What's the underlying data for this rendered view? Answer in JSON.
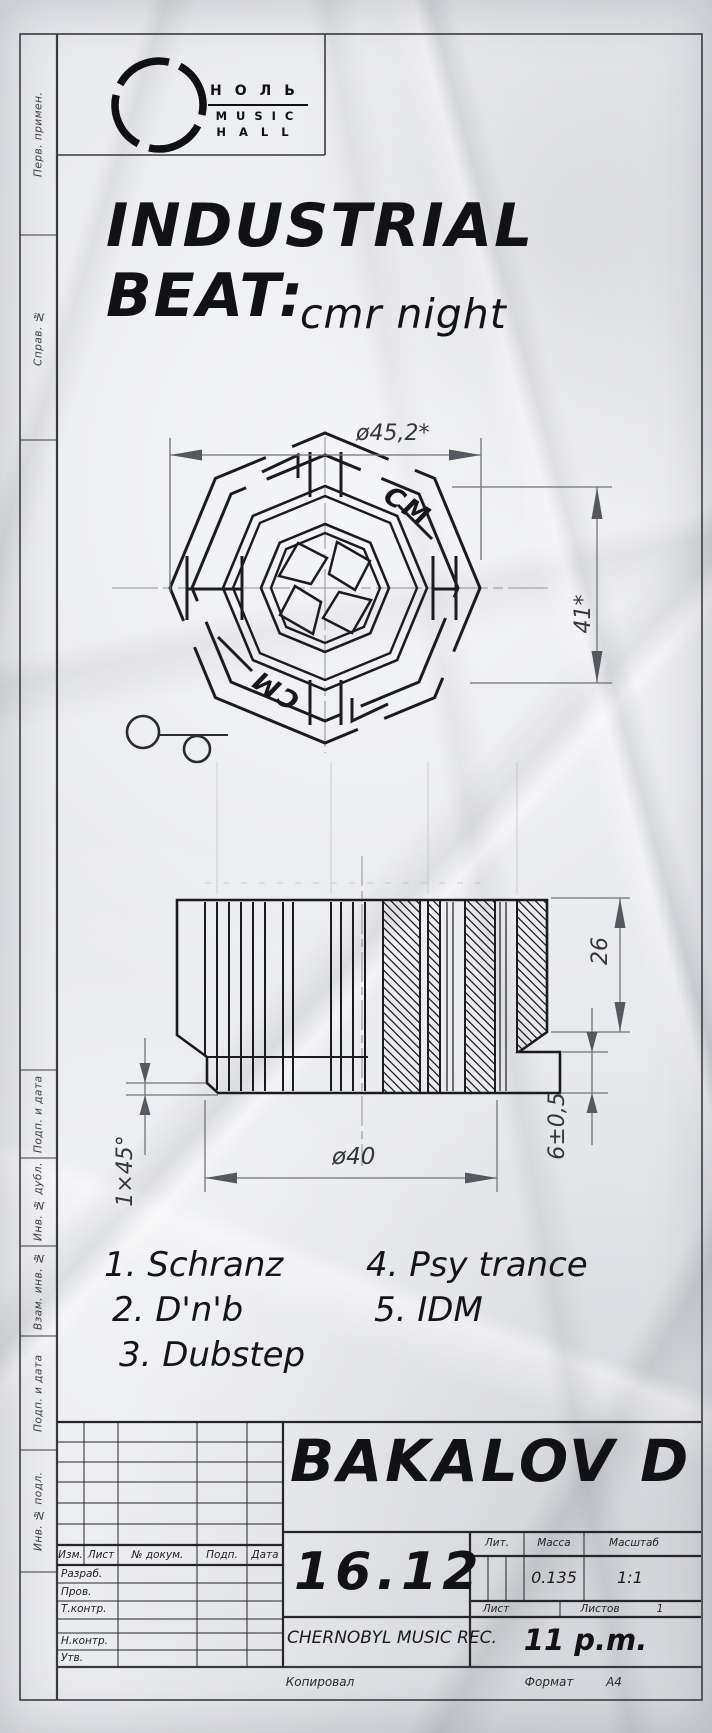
{
  "logo": {
    "line1": "НОЛЬ",
    "line2": "MUSIC",
    "line3": "HALL"
  },
  "title": {
    "line1": "INDUSTRIAL",
    "line2": "BEAT:",
    "sub": "cmr night"
  },
  "emblem": {
    "mark_top": "CM",
    "mark_bottom": "CM"
  },
  "dimensions": {
    "outer_diameter": "ø45,2*",
    "side_height": "41*",
    "section_height": "26",
    "bottom_diameter": "ø40",
    "chamfer": "1×45°",
    "flange": "6±0,5"
  },
  "genres": [
    "1. Schranz",
    "2. D'n'b",
    "3. Dubstep",
    "4. Psy trance",
    "5. IDM"
  ],
  "margin_labels": [
    "Перв. примен.",
    "Справ. №",
    "Подп. и дата",
    "Инв. № дубл.",
    "Взам. инв. №",
    "Подп. и дата",
    "Инв. № подл."
  ],
  "title_block": {
    "artist": "BAKALOV D",
    "date": "16.12",
    "label": "CHERNOBYL MUSIC REC.",
    "time": "11 p.m.",
    "header": {
      "izm": "Изм.",
      "list": "Лист",
      "doc": "№ докум.",
      "podp": "Подп.",
      "data": "Дата"
    },
    "rows": {
      "razrab": "Разраб.",
      "prov": "Пров.",
      "tkontr": "Т.контр.",
      "nkontr": "Н.контр.",
      "utv": "Утв."
    },
    "lit": "Лит.",
    "massa": "Масса",
    "masshtab": "Масштаб",
    "massa_value": "0.135",
    "scale_value": "1:1",
    "sheet": "Лист",
    "sheets": "Листов",
    "sheets_value": "1",
    "kopiroval": "Копировал",
    "format": "Формат",
    "format_value": "А4"
  },
  "colors": {
    "ink": "#1c1c1e",
    "dim_line": "#6f7278",
    "paper": "#e9eaee"
  }
}
